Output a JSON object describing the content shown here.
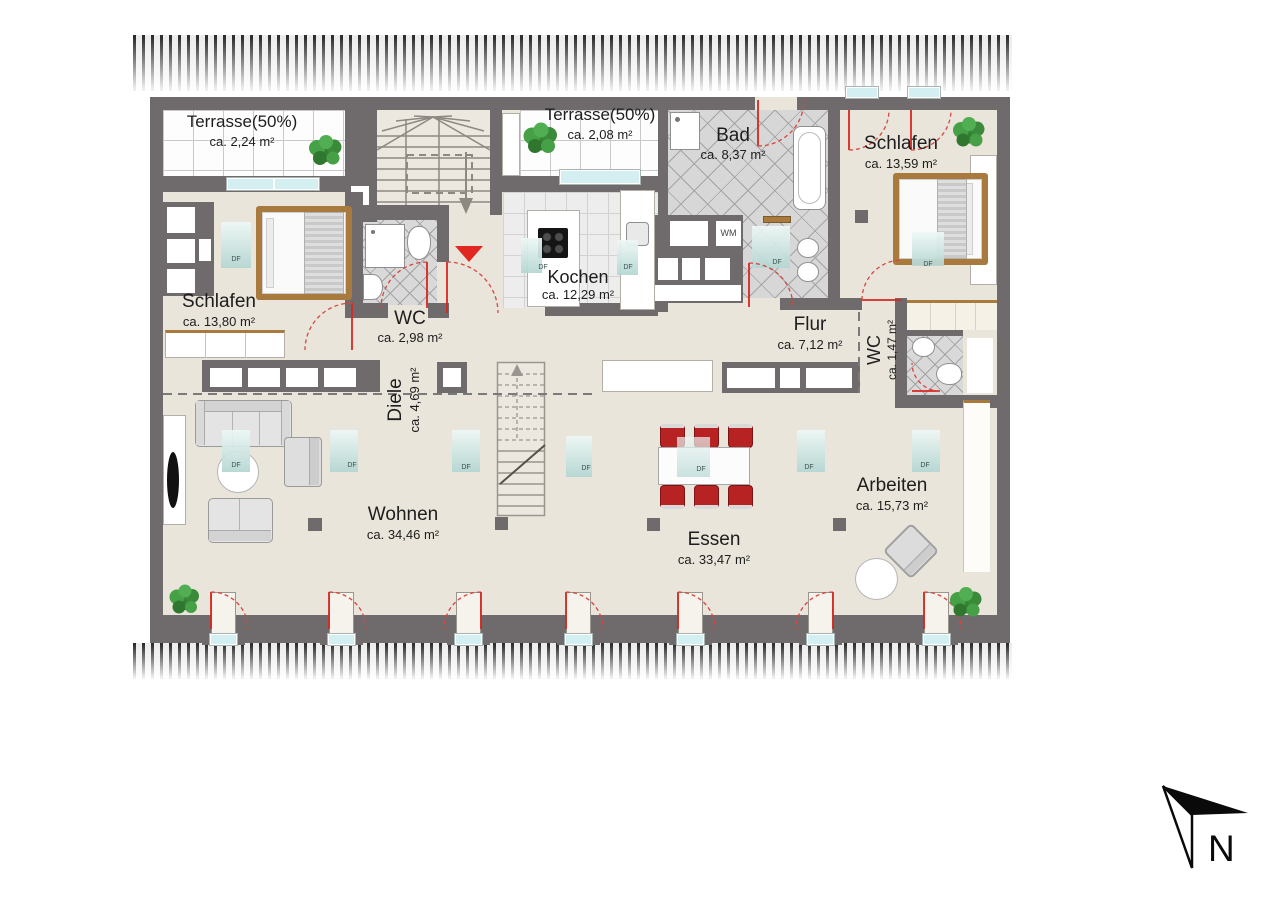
{
  "rooms": {
    "terrasse_left": {
      "name": "Terrasse(50%)",
      "area": "ca. 2,24 m²"
    },
    "terrasse_mid": {
      "name": "Terrasse(50%)",
      "area": "ca. 2,08 m²"
    },
    "bad": {
      "name": "Bad",
      "area": "ca. 8,37 m²"
    },
    "schlafen_right": {
      "name": "Schlafen",
      "area": "ca. 13,59 m²"
    },
    "schlafen_left": {
      "name": "Schlafen",
      "area": "ca. 13,80 m²"
    },
    "wc_mid": {
      "name": "WC",
      "area": "ca. 2,98 m²"
    },
    "kochen": {
      "name": "Kochen",
      "area": "ca. 12,29 m²"
    },
    "flur": {
      "name": "Flur",
      "area": "ca. 7,12 m²"
    },
    "wc_right": {
      "name": "WC",
      "area": "ca. 1,47 m²"
    },
    "diele": {
      "name": "Diele",
      "area": "ca. 4,69 m²"
    },
    "wohnen": {
      "name": "Wohnen",
      "area": "ca. 34,46 m²"
    },
    "essen": {
      "name": "Essen",
      "area": "ca. 33,47 m²"
    },
    "arbeiten": {
      "name": "Arbeiten",
      "area": "ca. 15,73 m²"
    }
  },
  "markers": {
    "wm": "WM",
    "df": "DF",
    "north": "N"
  },
  "colors": {
    "wall": "#6f6a6c",
    "floor": "#eae5db",
    "accent_red": "#d9261f",
    "window_teal": "#d4eff1",
    "wood_brown": "#a87a3e",
    "plant_green": "#3e8e3e",
    "chair_red": "#b72222"
  }
}
